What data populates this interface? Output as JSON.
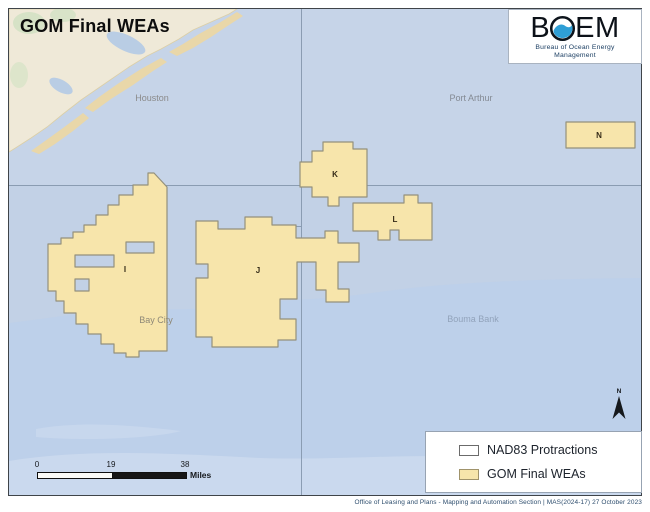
{
  "title": "GOM Final WEAs",
  "logo": {
    "letter_b": "B",
    "letters_em": "EM",
    "subtitle_line1": "Bureau of Ocean Energy",
    "subtitle_line2": "Management"
  },
  "map": {
    "place_labels": [
      {
        "id": "houston",
        "text": "Houston"
      },
      {
        "id": "port-arthur",
        "text": "Port Arthur"
      },
      {
        "id": "bay-city",
        "text": "Bay City"
      },
      {
        "id": "bouma-bank",
        "text": "Bouma Bank"
      }
    ],
    "wea_labels": [
      {
        "id": "wea-i",
        "text": "I"
      },
      {
        "id": "wea-j",
        "text": "J"
      },
      {
        "id": "wea-k",
        "text": "K"
      },
      {
        "id": "wea-l",
        "text": "L"
      },
      {
        "id": "wea-n",
        "text": "N"
      }
    ]
  },
  "north_arrow": {
    "label": "N"
  },
  "scale_bar": {
    "tick_0": "0",
    "tick_19": "19",
    "tick_38": "38",
    "unit": "Miles"
  },
  "legend": {
    "items": [
      {
        "label": "NAD83 Protractions",
        "swatch_color": "#ffffff"
      },
      {
        "label": "GOM Final WEAs",
        "swatch_color": "#f7e5ab"
      }
    ]
  },
  "footer": {
    "attribution": "Office of Leasing and Plans - Mapping and Automation Section | MAS(2024-17) 27 October 2023"
  },
  "colors": {
    "water": "#c2d1e6",
    "wea_fill": "#f7e5ab",
    "land": "#efe9d8",
    "grid_line": "#8597ad",
    "logo_wave_blue": "#2f9fd6"
  }
}
